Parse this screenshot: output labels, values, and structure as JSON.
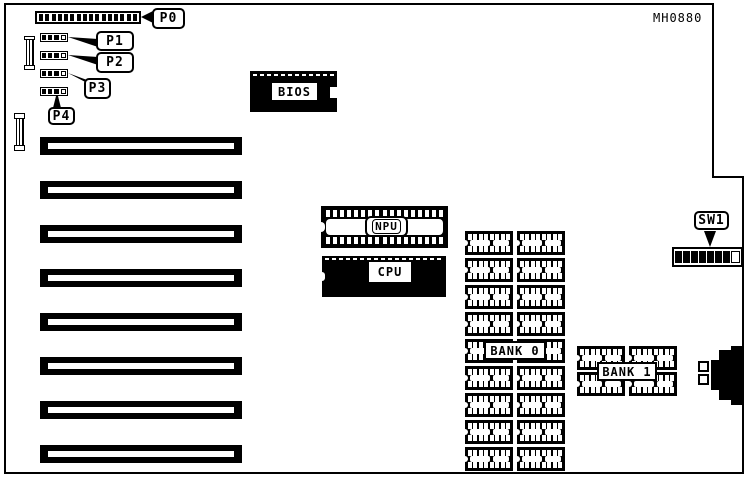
{
  "diagram": {
    "part_number": "MH0880"
  },
  "callouts": {
    "p0": "P0",
    "p1": "P1",
    "p2": "P2",
    "p3": "P3",
    "p4": "P4",
    "sw1": "SW1"
  },
  "chips": {
    "bios": "BIOS",
    "npu": "NPU",
    "cpu": "CPU",
    "bank0": "BANK 0",
    "bank1": "BANK 1"
  },
  "counts": {
    "expansion_slots": 8,
    "p0_pins": 16,
    "npu_pins": 17,
    "memory_chip_pins": 8,
    "bank0_rows": 9,
    "bank0_cols": 2,
    "bank1_rows": 2,
    "bank1_cols": 2,
    "sw1_switches": 8
  }
}
